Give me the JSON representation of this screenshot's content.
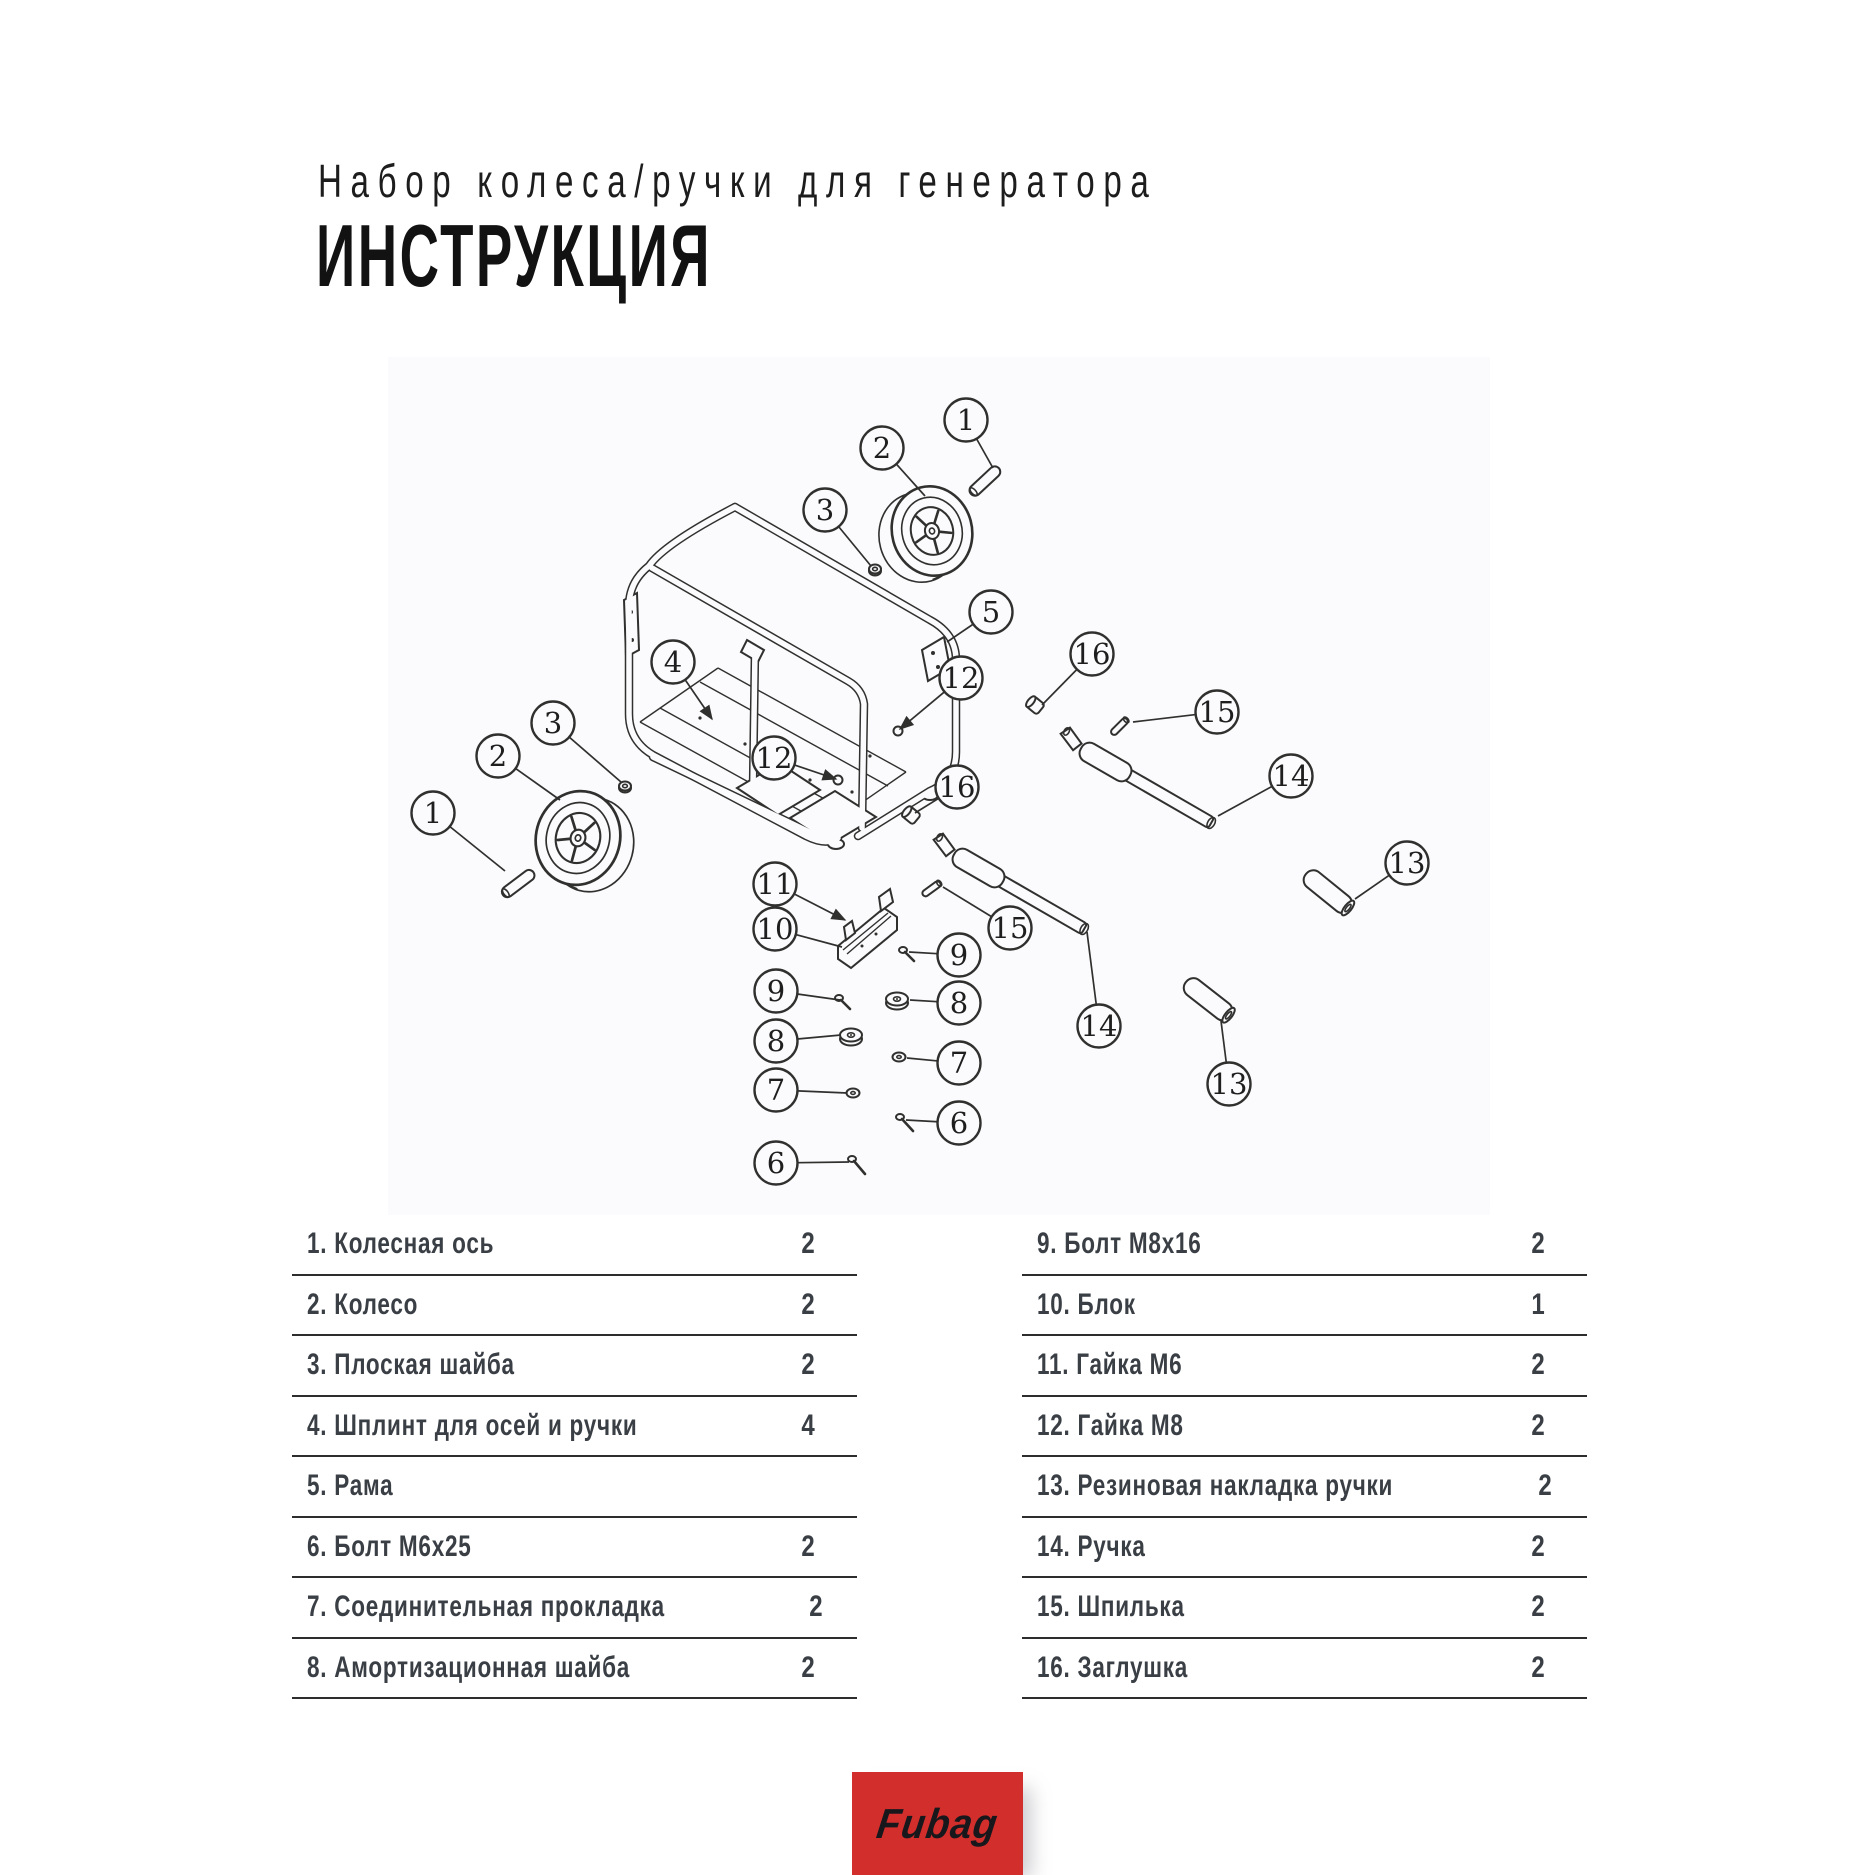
{
  "header": {
    "subtitle": "Набор колеса/ручки для генератора",
    "heading": "ИНСТРУКЦИЯ"
  },
  "diagram": {
    "description": "Exploded view of generator frame with wheel and handle kit",
    "callout_radius": 21.5,
    "callouts": [
      {
        "n": "1",
        "cx": 966,
        "cy": 420,
        "tx": 993,
        "ty": 468
      },
      {
        "n": "2",
        "cx": 882,
        "cy": 448,
        "tx": 925,
        "ty": 496
      },
      {
        "n": "3",
        "cx": 825,
        "cy": 510,
        "tx": 871,
        "ty": 566
      },
      {
        "n": "5",
        "cx": 991,
        "cy": 612,
        "tx": 947,
        "ty": 642
      },
      {
        "n": "4",
        "cx": 673,
        "cy": 662,
        "tx": 712,
        "ty": 719,
        "arrow": true
      },
      {
        "n": "12",
        "cx": 961,
        "cy": 678,
        "tx": 900,
        "ty": 729,
        "arrow": true
      },
      {
        "n": "16",
        "cx": 1092,
        "cy": 654,
        "tx": 1042,
        "ty": 705
      },
      {
        "n": "15",
        "cx": 1217,
        "cy": 712,
        "tx": 1133,
        "ty": 722
      },
      {
        "n": "14",
        "cx": 1291,
        "cy": 776,
        "tx": 1218,
        "ty": 816
      },
      {
        "n": "13",
        "cx": 1407,
        "cy": 863,
        "tx": 1355,
        "ty": 899
      },
      {
        "n": "3",
        "cx": 553,
        "cy": 723,
        "tx": 621,
        "ty": 782
      },
      {
        "n": "2",
        "cx": 498,
        "cy": 756,
        "tx": 560,
        "ty": 800
      },
      {
        "n": "1",
        "cx": 433,
        "cy": 813,
        "tx": 505,
        "ty": 871
      },
      {
        "n": "12",
        "cx": 774,
        "cy": 758,
        "tx": 836,
        "ty": 779,
        "arrow": true
      },
      {
        "n": "16",
        "cx": 957,
        "cy": 787,
        "tx": 915,
        "ty": 813
      },
      {
        "n": "11",
        "cx": 775,
        "cy": 884,
        "tx": 845,
        "ty": 920,
        "arrow": true
      },
      {
        "n": "10",
        "cx": 775,
        "cy": 929,
        "tx": 842,
        "ty": 947
      },
      {
        "n": "15",
        "cx": 1010,
        "cy": 928,
        "tx": 943,
        "ty": 887
      },
      {
        "n": "9",
        "cx": 959,
        "cy": 955,
        "tx": 909,
        "ty": 952
      },
      {
        "n": "9",
        "cx": 776,
        "cy": 991,
        "tx": 840,
        "ty": 1000
      },
      {
        "n": "8",
        "cx": 959,
        "cy": 1003,
        "tx": 910,
        "ty": 1000
      },
      {
        "n": "8",
        "cx": 776,
        "cy": 1041,
        "tx": 841,
        "ty": 1035
      },
      {
        "n": "7",
        "cx": 959,
        "cy": 1063,
        "tx": 907,
        "ty": 1058
      },
      {
        "n": "7",
        "cx": 776,
        "cy": 1090,
        "tx": 847,
        "ty": 1093
      },
      {
        "n": "6",
        "cx": 959,
        "cy": 1123,
        "tx": 906,
        "ty": 1120
      },
      {
        "n": "6",
        "cx": 776,
        "cy": 1163,
        "tx": 849,
        "ty": 1162
      },
      {
        "n": "14",
        "cx": 1099,
        "cy": 1026,
        "tx": 1087,
        "ty": 932
      },
      {
        "n": "13",
        "cx": 1229,
        "cy": 1084,
        "tx": 1221,
        "ty": 1021
      }
    ]
  },
  "parts_left": [
    {
      "num": "1.",
      "name": "Колесная ось",
      "qty": "2"
    },
    {
      "num": "2.",
      "name": "Колесо",
      "qty": "2"
    },
    {
      "num": "3.",
      "name": "Плоская шайба",
      "qty": "2"
    },
    {
      "num": "4.",
      "name": "Шплинт для осей и ручки",
      "qty": "4"
    },
    {
      "num": "5.",
      "name": "Рама",
      "qty": ""
    },
    {
      "num": "6.",
      "name": "Болт М6х25",
      "qty": "2"
    },
    {
      "num": "7.",
      "name": "Соединительная прокладка",
      "qty": "2"
    },
    {
      "num": "8.",
      "name": "Амортизационная шайба",
      "qty": "2"
    }
  ],
  "parts_right": [
    {
      "num": "9.",
      "name": "Болт М8х16",
      "qty": "2"
    },
    {
      "num": "10.",
      "name": "Блок",
      "qty": "1"
    },
    {
      "num": "11.",
      "name": "Гайка М6",
      "qty": "2"
    },
    {
      "num": "12.",
      "name": "Гайка М8",
      "qty": "2"
    },
    {
      "num": "13.",
      "name": "Резиновая накладка ручки",
      "qty": "2"
    },
    {
      "num": "14.",
      "name": "Ручка",
      "qty": "2"
    },
    {
      "num": "15.",
      "name": "Шпилька",
      "qty": "2"
    },
    {
      "num": "16.",
      "name": "Заглушка",
      "qty": "2"
    }
  ],
  "footer": {
    "brand": "Fubag",
    "brand_bg": "#d22f2c"
  },
  "colors": {
    "accent_red": "#d22f2c",
    "panel_bg": "#fbfafc",
    "line": "#30302f",
    "list_text": "#3a3f45"
  }
}
